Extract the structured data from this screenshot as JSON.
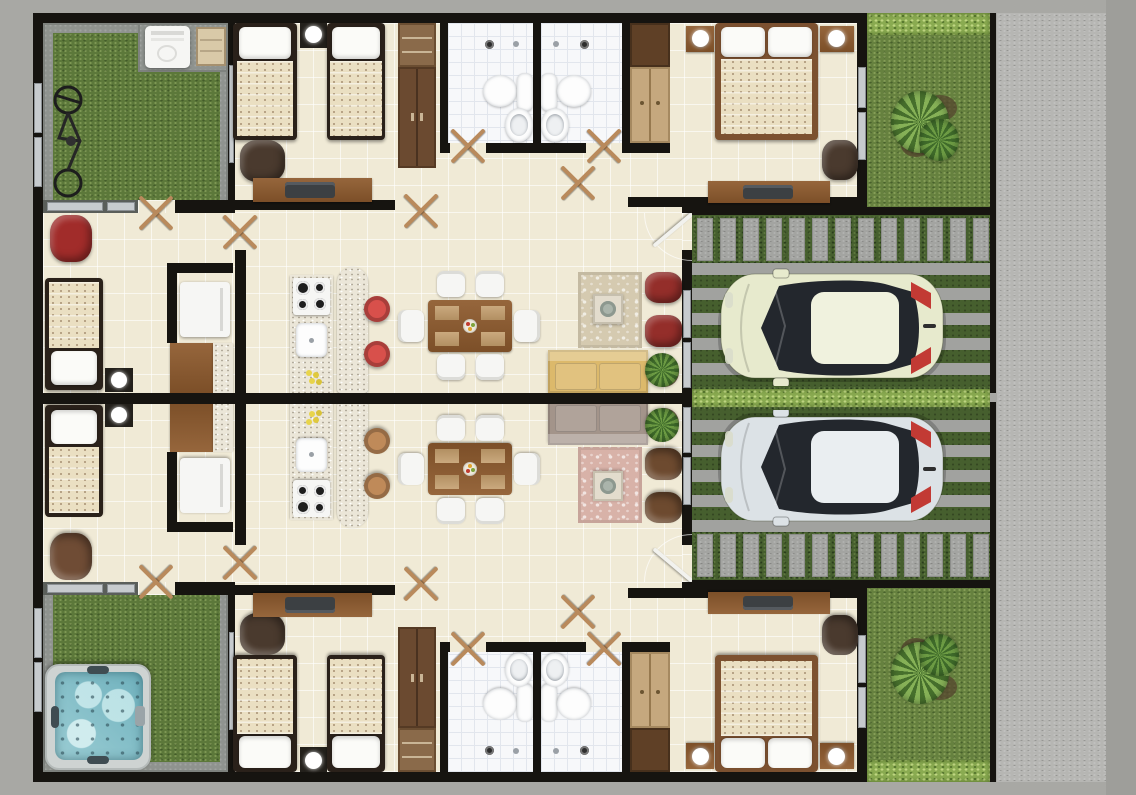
{
  "scene": {
    "title": "Duplex floor plan – top-down 3D render",
    "view": "top-down",
    "units_count": 2,
    "layout": "two mirrored residential units sharing a central party wall, driveways on the right, sidewalk on far right",
    "visible_text": "none"
  },
  "palette": {
    "background": "#a8a8a4",
    "background_right_edge": "#9e9e9a",
    "sidewalk": "#b6b6b3",
    "wall": "#161410",
    "floor_tile": "#f0ead6",
    "bathroom_tile": "#f7f8fa",
    "patio_concrete": "#8f938f",
    "grass": "#5c783a",
    "driveway_grass": "#465f2e",
    "hedge": "#8aab51",
    "paver": "#a3a4a1",
    "wood": "#8a5a33",
    "closet_shelf": "#c5a87e",
    "granite_counter": "#ebe6d8",
    "mattress_quilt": "#eadfc2",
    "pillow": "#fbfbf8",
    "fixture_white": "#fdfdfd",
    "hot_tub_water": "#8cc4cc",
    "taillight_red": "#c23a34"
  },
  "site": {
    "features": [
      "perimeter sidewalk",
      "front yards with shrub and hedge",
      "paver front walkways",
      "two paver-strip driveways",
      "hedge strip between driveways",
      "central party wall"
    ]
  },
  "units": [
    {
      "id": "unit-a",
      "position": "top",
      "rooms": [
        "patio-garden",
        "single-bedroom",
        "twin-bedroom",
        "bathroom-1",
        "bathroom-2",
        "master-bedroom",
        "kitchen",
        "dining-room",
        "living-room",
        "hallway",
        "driveway",
        "front-yard"
      ],
      "patio_items": [
        "washing-machine",
        "storage-shelf",
        "bicycle"
      ],
      "furniture": {
        "single_beds": 3,
        "double_beds": 1,
        "nightstand_lamps": 4,
        "desks": 2,
        "laptops": 2,
        "desk_chairs": 2,
        "accent_chairs": 1,
        "wardrobes": 2,
        "toilets": 2,
        "sinks": 2,
        "showers": 2,
        "refrigerator": 1,
        "stove_burners": 4,
        "kitchen_sink": 1,
        "kitchen_island": 1,
        "bar_stools": 2,
        "dining_table": 1,
        "dining_chairs": 6,
        "sofa": 1,
        "armchairs": 2,
        "coffee_table": 1,
        "rug": 1,
        "potted_plant": 1,
        "car": 1
      },
      "palette": {
        "accent_chair": "#a12c2a",
        "bar_stool": "#d8504b",
        "armchair": "#942e2a",
        "sofa": "#dcb96b",
        "rug": "#d5cab0",
        "car_body": "#e7eacd",
        "car_roof": "#f0f2de",
        "car_glass": "#23272d"
      }
    },
    {
      "id": "unit-b",
      "position": "bottom",
      "rooms": [
        "patio-garden",
        "single-bedroom",
        "twin-bedroom",
        "bathroom-1",
        "bathroom-2",
        "master-bedroom",
        "kitchen",
        "dining-room",
        "living-room",
        "hallway",
        "driveway",
        "front-yard"
      ],
      "patio_items": [
        "hot-tub"
      ],
      "furniture": {
        "single_beds": 3,
        "double_beds": 1,
        "nightstand_lamps": 4,
        "desks": 2,
        "laptops": 2,
        "desk_chairs": 2,
        "accent_chairs": 1,
        "wardrobes": 2,
        "toilets": 2,
        "sinks": 2,
        "showers": 2,
        "refrigerator": 1,
        "stove_burners": 4,
        "kitchen_sink": 1,
        "kitchen_island": 1,
        "bar_stools": 2,
        "dining_table": 1,
        "dining_chairs": 6,
        "sofa": 1,
        "armchairs": 2,
        "coffee_table": 1,
        "rug": 1,
        "potted_plant": 1,
        "car": 1
      },
      "palette": {
        "accent_chair": "#6f4c35",
        "bar_stool": "#bf8a59",
        "armchair": "#6d4a2f",
        "sofa": "#a3948a",
        "rug": "#d8b2a8",
        "car_body": "#dce2e6",
        "car_roof": "#eaeef1",
        "car_glass": "#23272d"
      }
    }
  ]
}
